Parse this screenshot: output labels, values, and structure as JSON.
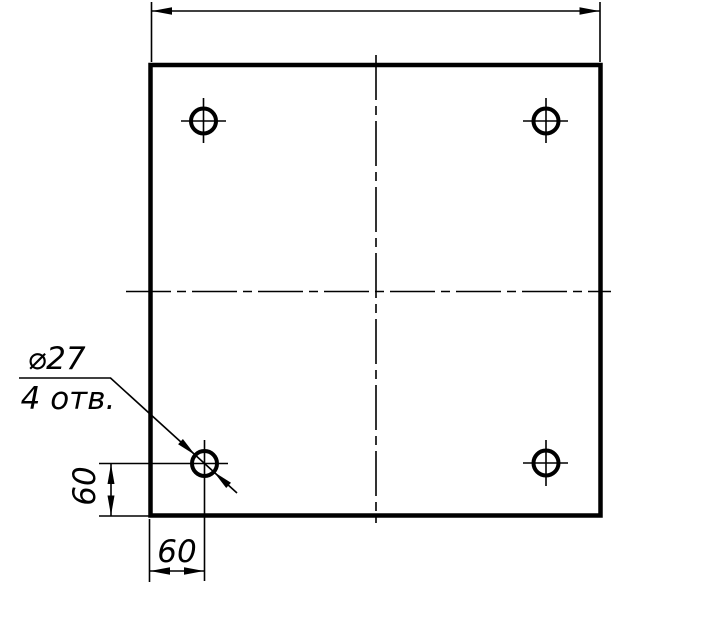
{
  "drawing": {
    "kind": "engineering-drawing",
    "description": "square plate front view with four corner holes",
    "colors": {
      "line": "#000000",
      "background": "#ffffff"
    },
    "callout": {
      "diameter": "⌀27",
      "count": "4 отв."
    },
    "dims": {
      "hole_offset_from_left_edge": "60",
      "hole_offset_from_bottom_edge": "60",
      "overall_width_label": ""
    }
  }
}
